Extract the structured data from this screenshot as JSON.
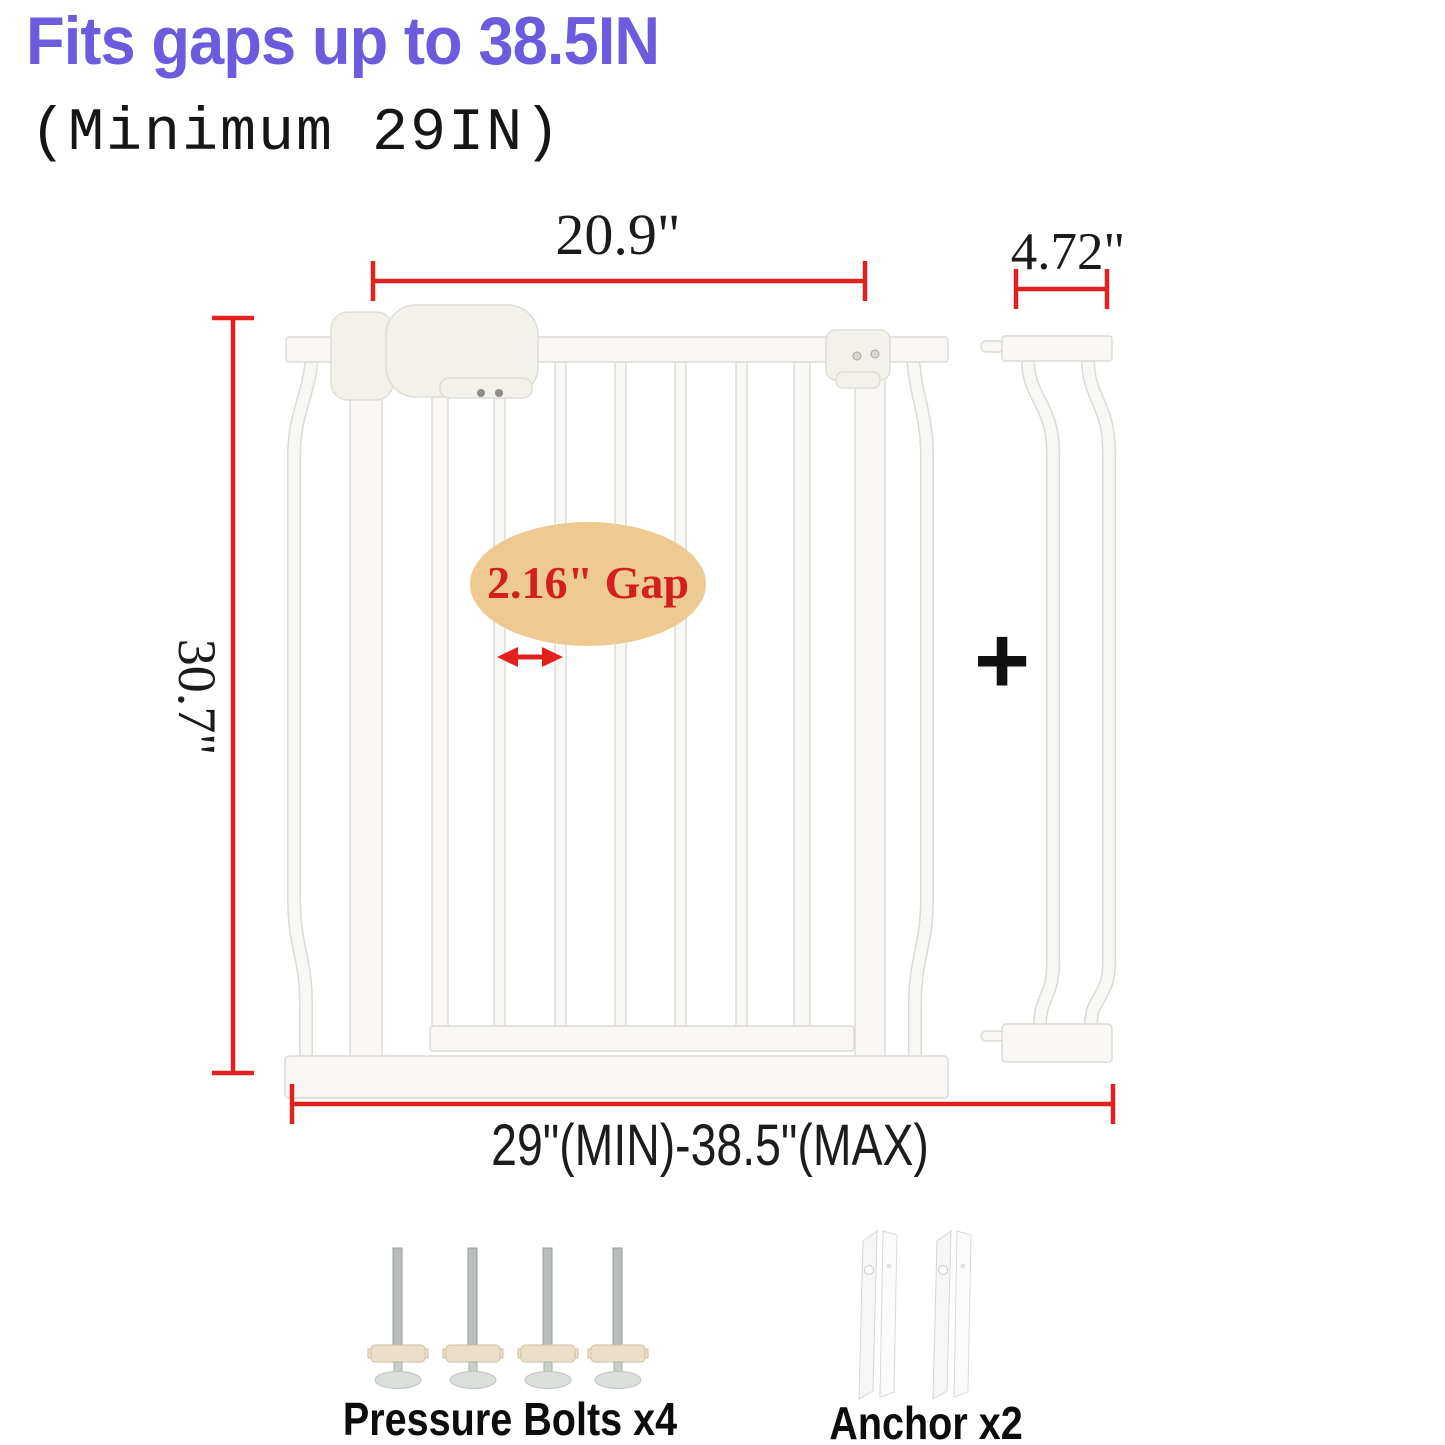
{
  "header": {
    "title": "Fits gaps up to 38.5IN",
    "subtitle": "(Minimum 29IN)"
  },
  "dimensions": {
    "gate_width": "20.9\"",
    "extension_width": "4.72\"",
    "gate_height": "30.7\"",
    "bar_gap": "2.16\" Gap",
    "fit_range": "29\"(MIN)-38.5\"(MAX)"
  },
  "plus_sign": "+",
  "included_parts": {
    "pressure_bolts_label": "Pressure Bolts x4",
    "anchors_label": "Anchor x2"
  },
  "colors": {
    "title_purple": "#6c5cdd",
    "dimension_red": "#e2201d",
    "gap_ellipse_tan": "#ecca92",
    "gap_text_red": "#d3201f",
    "label_black": "#141414"
  }
}
